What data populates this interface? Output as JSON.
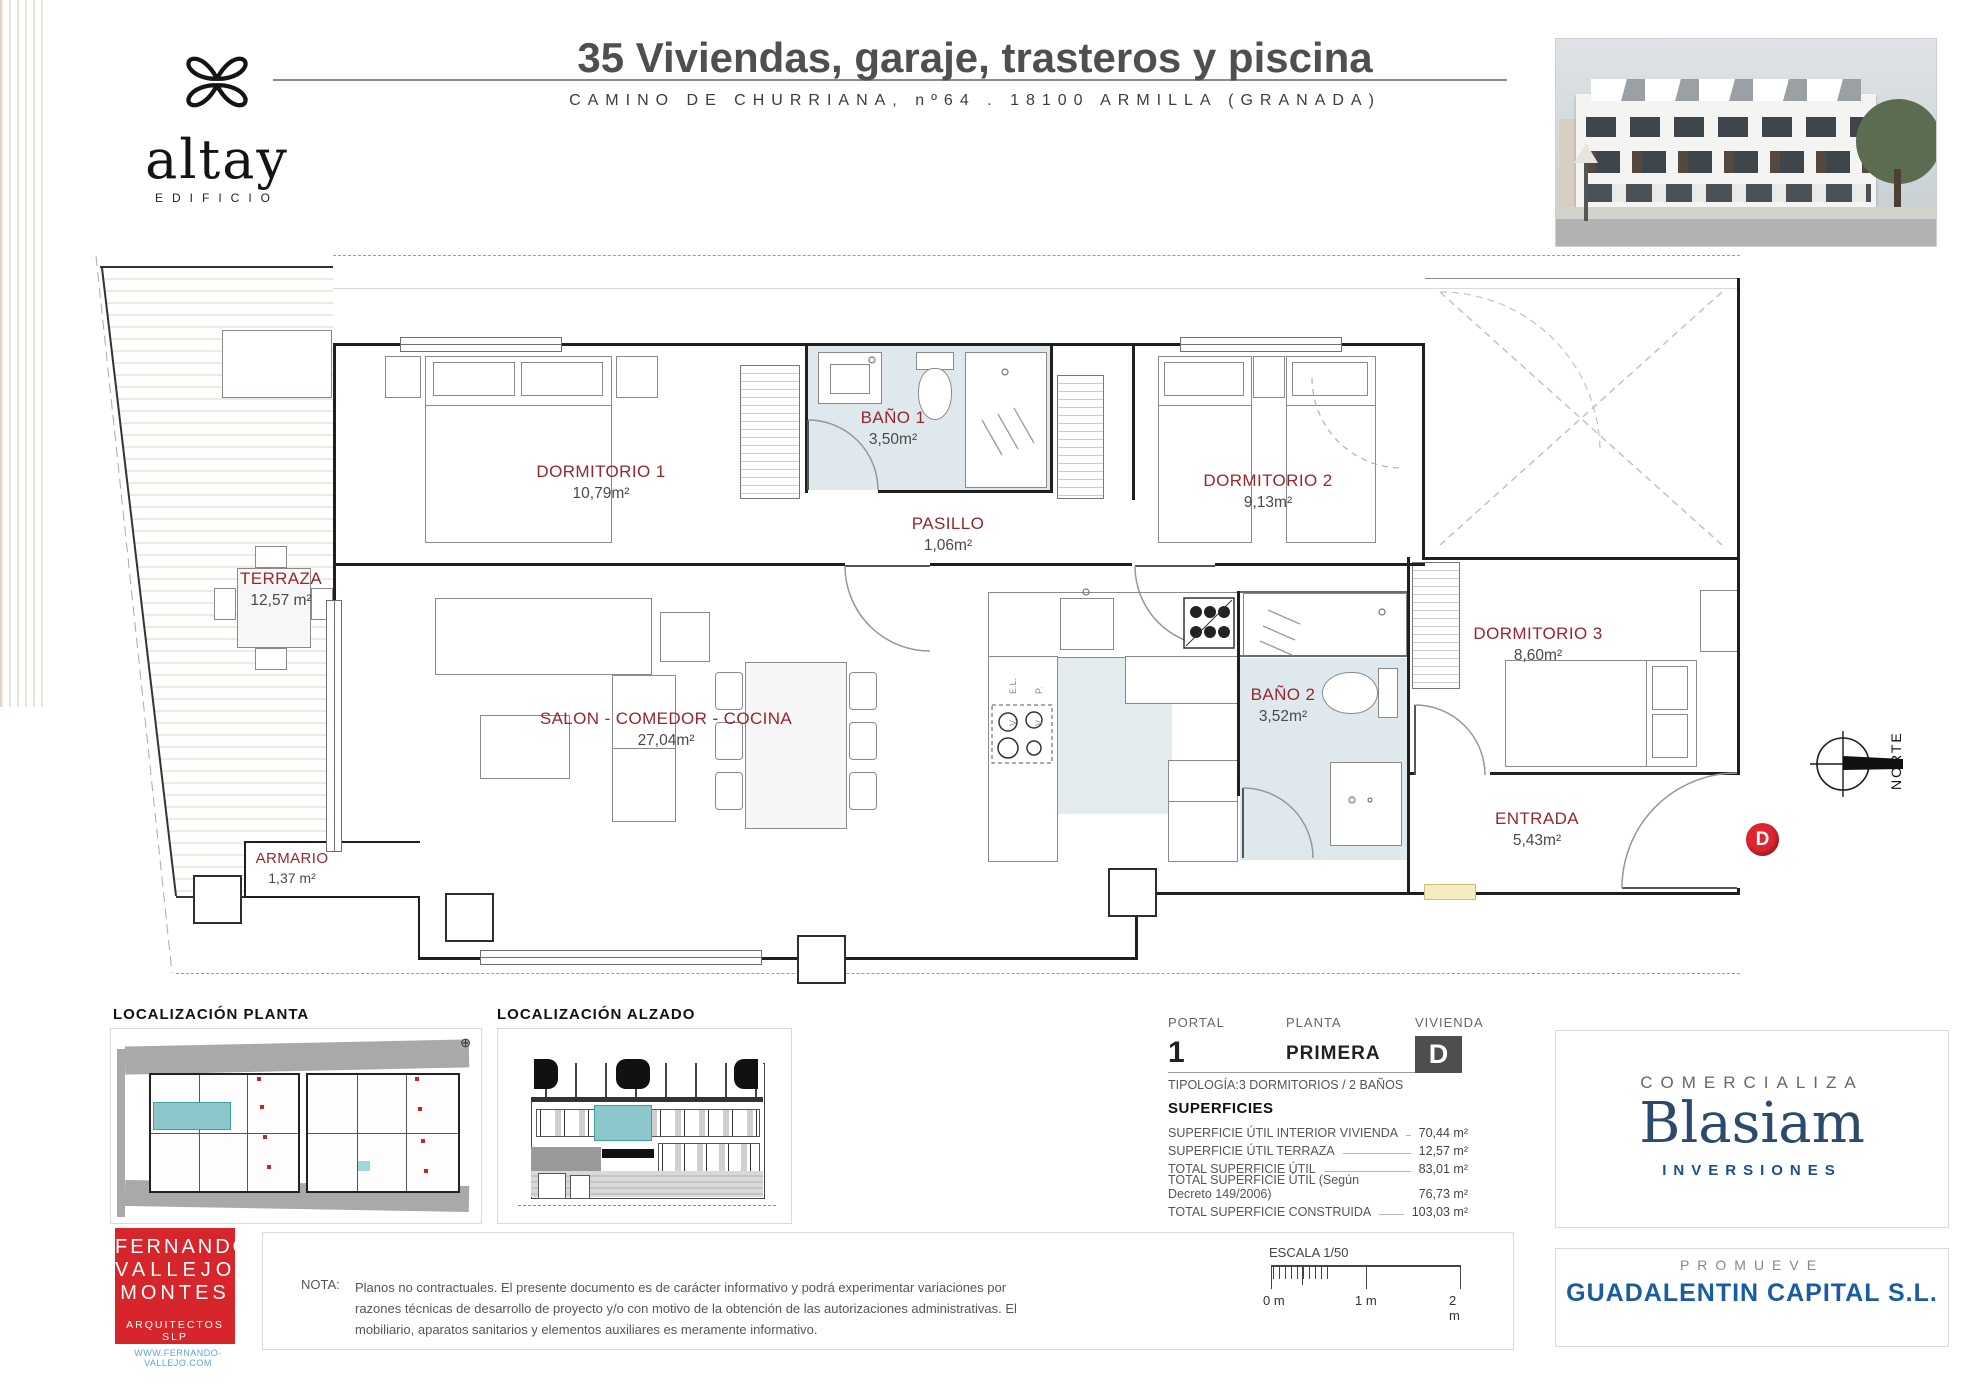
{
  "header": {
    "brand": "altay",
    "brand_sub": "EDIFICIO",
    "title": "35 Viviendas, garaje, trasteros y piscina",
    "subtitle": "CAMINO DE CHURRIANA, nº64 . 18100 ARMILLA (GRANADA)"
  },
  "plan": {
    "rooms": [
      {
        "name": "TERRAZA",
        "area": "12,57 m²"
      },
      {
        "name": "DORMITORIO 1",
        "area": "10,79m²"
      },
      {
        "name": "BAÑO 1",
        "area": "3,50m²"
      },
      {
        "name": "PASILLO",
        "area": "1,06m²"
      },
      {
        "name": "DORMITORIO 2",
        "area": "9,13m²"
      },
      {
        "name": "DORMITORIO 3",
        "area": "8,60m²"
      },
      {
        "name": "SALON - COMEDOR - COCINA",
        "area": "27,04m²"
      },
      {
        "name": "BAÑO 2",
        "area": "3,52m²"
      },
      {
        "name": "ENTRADA",
        "area": "5,43m²"
      },
      {
        "name": "ARMARIO",
        "area": "1,37 m²"
      }
    ],
    "kitchen_labels": [
      "E.L.",
      "P.",
      "V.",
      "V."
    ],
    "north": "NORTE",
    "marker": "D"
  },
  "localizacion": {
    "planta": "LOCALIZACIÓN  PLANTA",
    "alzado": "LOCALIZACIÓN  ALZADO"
  },
  "unit_info": {
    "portal_label": "PORTAL",
    "portal": "1",
    "planta_label": "PLANTA",
    "planta": "PRIMERA",
    "vivienda_label": "VIVIENDA",
    "vivienda": "D",
    "tipologia": "TIPOLOGÍA:3 DORMITORIOS / 2 BAÑOS",
    "superficies_title": "SUPERFICIES",
    "superficies": [
      {
        "label": "SUPERFICIE ÚTIL INTERIOR VIVIENDA",
        "value": "70,44 m²"
      },
      {
        "label": "SUPERFICIE ÚTIL TERRAZA",
        "value": "12,57 m²"
      },
      {
        "label": "TOTAL SUPERFICIE ÚTIL",
        "value": "83,01 m²"
      },
      {
        "label": "TOTAL SUPERFICIE ÚTIL (Según Decreto 149/2006)",
        "value": "76,73 m²"
      },
      {
        "label": "TOTAL SUPERFICIE CONSTRUIDA",
        "value": "103,03 m²"
      }
    ]
  },
  "nota": {
    "label": "NOTA:",
    "text": "Planos no contractuales. El presente documento es de carácter informativo y podrá experimentar variaciones por razones técnicas de desarrollo de proyecto y/o con motivo de la obtención de las autorizaciones administrativas. El mobiliario, aparatos sanitarios y elementos auxiliares es meramente informativo."
  },
  "escala": {
    "label": "ESCALA 1/50",
    "ticks": [
      "0 m",
      "1 m",
      "2 m"
    ]
  },
  "commercial": {
    "comercializa": "COMERCIALIZA",
    "brand": "Blasiam",
    "brand_sub": "INVERSIONES",
    "promueve": "PROMUEVE",
    "promotor": "GUADALENTIN CAPITAL S.L."
  },
  "architect": {
    "line1": "FERNANDO",
    "line2": "VALLEJO",
    "line3": "MONTES",
    "sub": "ARQUITECTOS SLP",
    "web": "WWW.FERNANDO-VALLEJO.COM"
  }
}
